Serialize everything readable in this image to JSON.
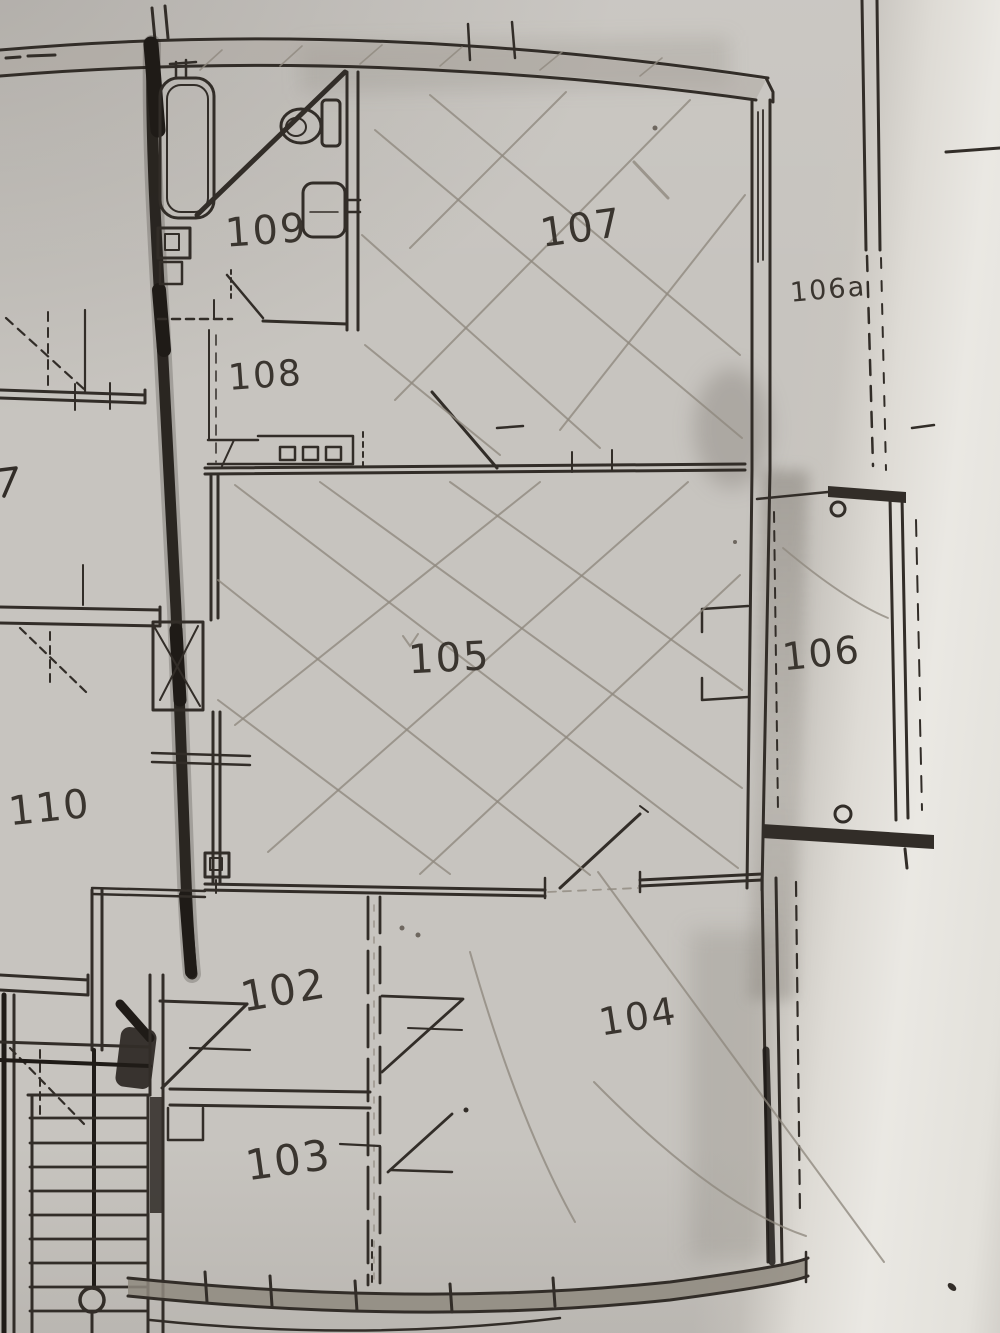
{
  "document_type": "floor-plan",
  "rooms": {
    "r102": "102",
    "r103": "103",
    "r104": "104",
    "r105": "105",
    "r106": "106",
    "r106a": "106a",
    "r107": "107",
    "r108": "108",
    "r109": "109",
    "r110": "110"
  },
  "colors": {
    "paper": "#c7c4bf",
    "paper_bright": "#eae8e3",
    "ink": "#322d28",
    "pencil": "#8e887e",
    "marker_highlight": "#1f1b17",
    "wall_fill": "#8f897f"
  }
}
